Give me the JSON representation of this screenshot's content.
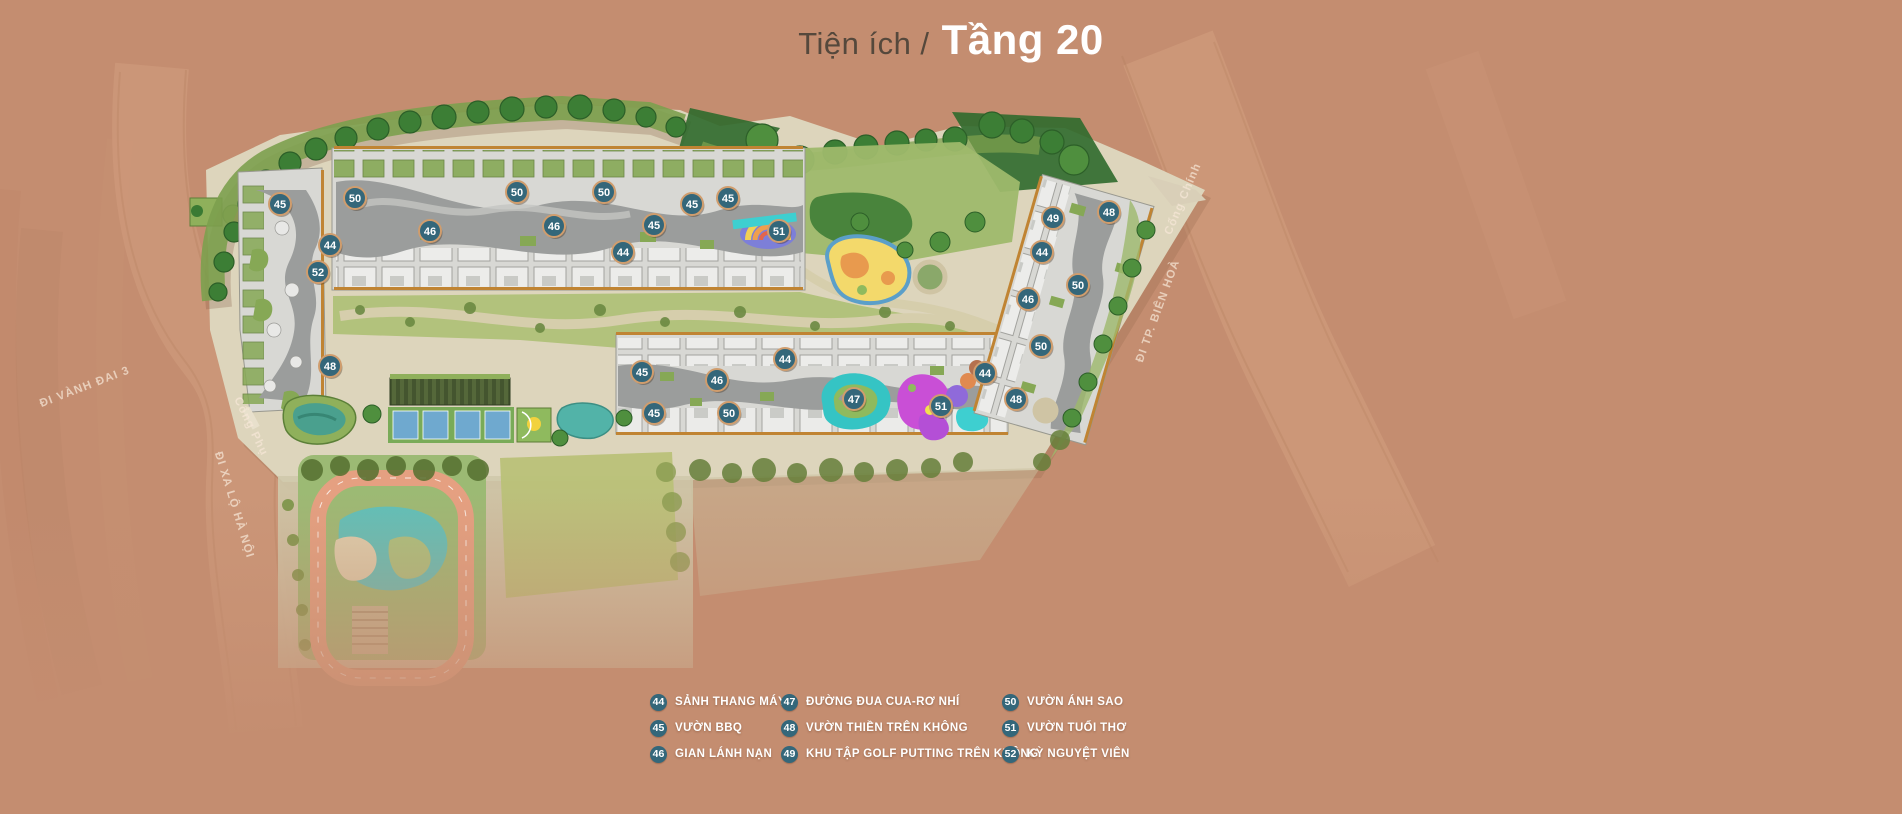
{
  "header": {
    "title_prefix": "Tiện ích /",
    "title_current": "Tầng 20"
  },
  "colors": {
    "bg": "#c48d70",
    "badge": "#34677a",
    "badge_ring": "#d09d6d",
    "legend_text": "#ffffff",
    "title_prefix": "#55483c",
    "title_current": "#ffffff"
  },
  "legend": {
    "columns": [
      {
        "x": 0,
        "items": [
          {
            "num": "44",
            "label": "SẢNH THANG MÁY"
          },
          {
            "num": "45",
            "label": "VƯỜN BBQ"
          },
          {
            "num": "46",
            "label": "GIAN LÁNH NẠN"
          }
        ]
      },
      {
        "x": 131,
        "items": [
          {
            "num": "47",
            "label": "ĐƯỜNG ĐUA CUA-RƠ NHÍ"
          },
          {
            "num": "48",
            "label": "VƯỜN THIỀN TRÊN KHÔNG"
          },
          {
            "num": "49",
            "label": "KHU TẬP GOLF PUTTING TRÊN KHÔNG"
          }
        ]
      },
      {
        "x": 352,
        "items": [
          {
            "num": "50",
            "label": "VƯỜN ÁNH SAO"
          },
          {
            "num": "51",
            "label": "VƯỜN TUỔI THƠ"
          },
          {
            "num": "52",
            "label": "KỲ NGUYỆT VIÊN"
          }
        ]
      }
    ]
  },
  "map": {
    "road_labels": [
      {
        "text": "ĐI VÀNH ĐAI 3",
        "x": 86,
        "y": 390,
        "rotate": -21
      },
      {
        "text": "Cổng Phụ",
        "x": 248,
        "y": 428,
        "rotate": 64
      },
      {
        "text": "ĐI XA LỘ HÀ NỘI",
        "x": 231,
        "y": 506,
        "rotate": 73
      },
      {
        "text": "Cổng Chính",
        "x": 1186,
        "y": 200,
        "rotate": -67
      },
      {
        "text": "ĐI TP. BIÊN HOÀ",
        "x": 1161,
        "y": 312,
        "rotate": -70
      }
    ],
    "markers": [
      {
        "num": "45",
        "x": 280,
        "y": 204
      },
      {
        "num": "50",
        "x": 355,
        "y": 198
      },
      {
        "num": "44",
        "x": 330,
        "y": 245
      },
      {
        "num": "52",
        "x": 318,
        "y": 272
      },
      {
        "num": "48",
        "x": 330,
        "y": 366
      },
      {
        "num": "46",
        "x": 430,
        "y": 231
      },
      {
        "num": "50",
        "x": 517,
        "y": 192
      },
      {
        "num": "46",
        "x": 554,
        "y": 226
      },
      {
        "num": "50",
        "x": 604,
        "y": 192
      },
      {
        "num": "44",
        "x": 623,
        "y": 252
      },
      {
        "num": "45",
        "x": 654,
        "y": 225
      },
      {
        "num": "45",
        "x": 692,
        "y": 204
      },
      {
        "num": "45",
        "x": 728,
        "y": 198
      },
      {
        "num": "51",
        "x": 779,
        "y": 231
      },
      {
        "num": "45",
        "x": 642,
        "y": 372
      },
      {
        "num": "46",
        "x": 717,
        "y": 380
      },
      {
        "num": "45",
        "x": 654,
        "y": 413
      },
      {
        "num": "50",
        "x": 729,
        "y": 413
      },
      {
        "num": "44",
        "x": 785,
        "y": 359
      },
      {
        "num": "47",
        "x": 854,
        "y": 399
      },
      {
        "num": "51",
        "x": 941,
        "y": 406
      },
      {
        "num": "44",
        "x": 985,
        "y": 373
      },
      {
        "num": "48",
        "x": 1016,
        "y": 399
      },
      {
        "num": "49",
        "x": 1053,
        "y": 218
      },
      {
        "num": "48",
        "x": 1109,
        "y": 212
      },
      {
        "num": "44",
        "x": 1042,
        "y": 252
      },
      {
        "num": "50",
        "x": 1078,
        "y": 285
      },
      {
        "num": "46",
        "x": 1028,
        "y": 299
      },
      {
        "num": "50",
        "x": 1041,
        "y": 346
      }
    ]
  }
}
